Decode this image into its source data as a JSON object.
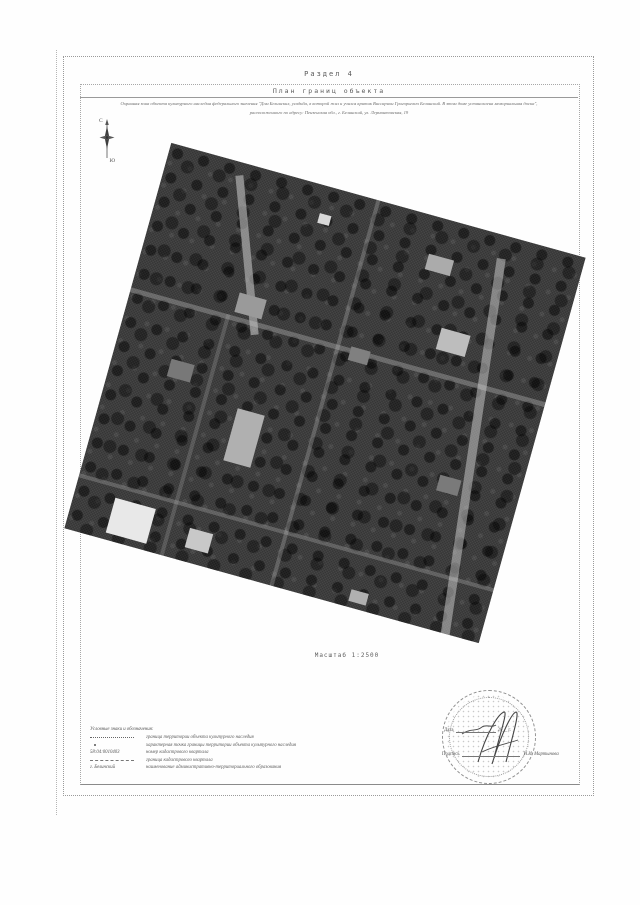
{
  "document": {
    "section_label": "Раздел 4",
    "title": "План границ объекта",
    "description_line1": "Охранная зона объекта культурного наследия федерального значения \"Дом Белинских, усадьба, в которой жил и учился критик Виссарион Григорьевич Белинский. В этом доме установлена мемориальная доска\",",
    "description_line2": "расположенного по адресу: Пензенская обл., г. Белинский, ул. Лермонтовская, 19",
    "scale_label": "Масштаб 1:2500"
  },
  "compass": {
    "north_label": "С",
    "south_label": "Ю"
  },
  "legend": {
    "header": "Условные знаки и обозначения:",
    "items": [
      {
        "label": "граница территории объекта культурного наследия"
      },
      {
        "label": "характерная точка границы территории объекта культурного наследия"
      },
      {
        "symbol_text": "58:04:0010403",
        "label": "номер кадастрового квартала"
      },
      {
        "label": "граница кадастрового квартала"
      },
      {
        "symbol_text": "г. Белинский",
        "label": "наименование административно-территориального образования"
      }
    ]
  },
  "stamp": {
    "date_label": "Дата",
    "date_suffix": "20__ г.",
    "signature_label": "Подпись",
    "signer_name": "Н.И. Мартынова"
  }
}
